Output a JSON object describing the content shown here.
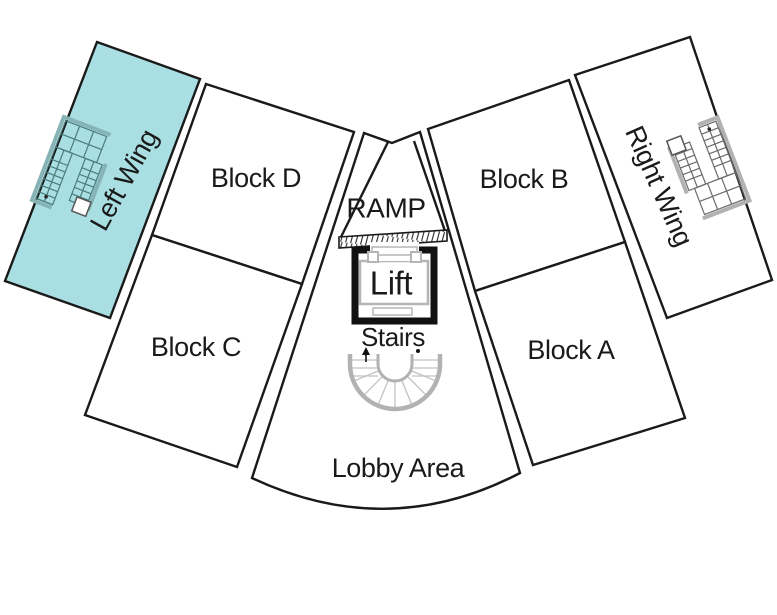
{
  "diagram": {
    "type": "building-floor-plan",
    "areas": {
      "left_wing": {
        "label": "Left Wing",
        "highlighted": true,
        "fill": "#a9dfe2"
      },
      "block_d": {
        "label": "Block D"
      },
      "ramp": {
        "label": "RAMP"
      },
      "block_b": {
        "label": "Block B"
      },
      "right_wing": {
        "label": "Right Wing"
      },
      "block_c": {
        "label": "Block C"
      },
      "lift": {
        "label": "Lift"
      },
      "stairs": {
        "label": "Stairs"
      },
      "block_a": {
        "label": "Block A"
      },
      "lobby": {
        "label": "Lobby Area"
      }
    },
    "colors": {
      "background": "#ffffff",
      "outline": "#1a1a1a",
      "highlight_fill": "#a9dfe2",
      "highlight_text": "#16403f",
      "stair_gray": "#b2b2b2"
    }
  }
}
